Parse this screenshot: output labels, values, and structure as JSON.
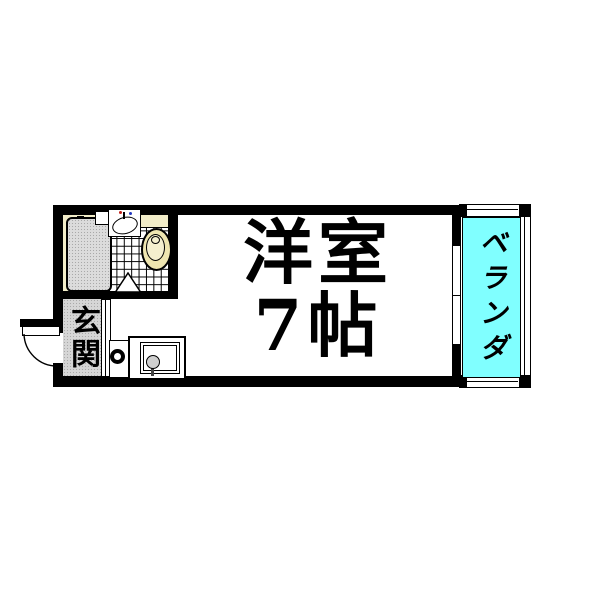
{
  "floorplan": {
    "main_room": {
      "label_line1": "洋室",
      "label_line2": "7帖",
      "type": "western-room",
      "size": "7帖"
    },
    "veranda": {
      "label": "ベランダ",
      "floor_color": "#80FFFF"
    },
    "entrance": {
      "label": "玄関"
    },
    "colors": {
      "wall": "#000000",
      "bathroom_cream": "#F1ECC8",
      "toilet_cream": "#EEE5B0",
      "bathtub_gray": "#DCDCDC",
      "entrance_gray": "#D6D6D6",
      "veranda_cyan": "#80FFFF",
      "hot_tap": "#c22018",
      "cold_tap": "#2338c0"
    },
    "fixtures": [
      "bathtub",
      "washbasin",
      "toilet",
      "tiled-wc-floor",
      "wc-door-swing",
      "kitchen-sink",
      "single-burner-stove",
      "entrance-step",
      "hinged-entrance-door",
      "sliding-window",
      "veranda-railing"
    ]
  }
}
